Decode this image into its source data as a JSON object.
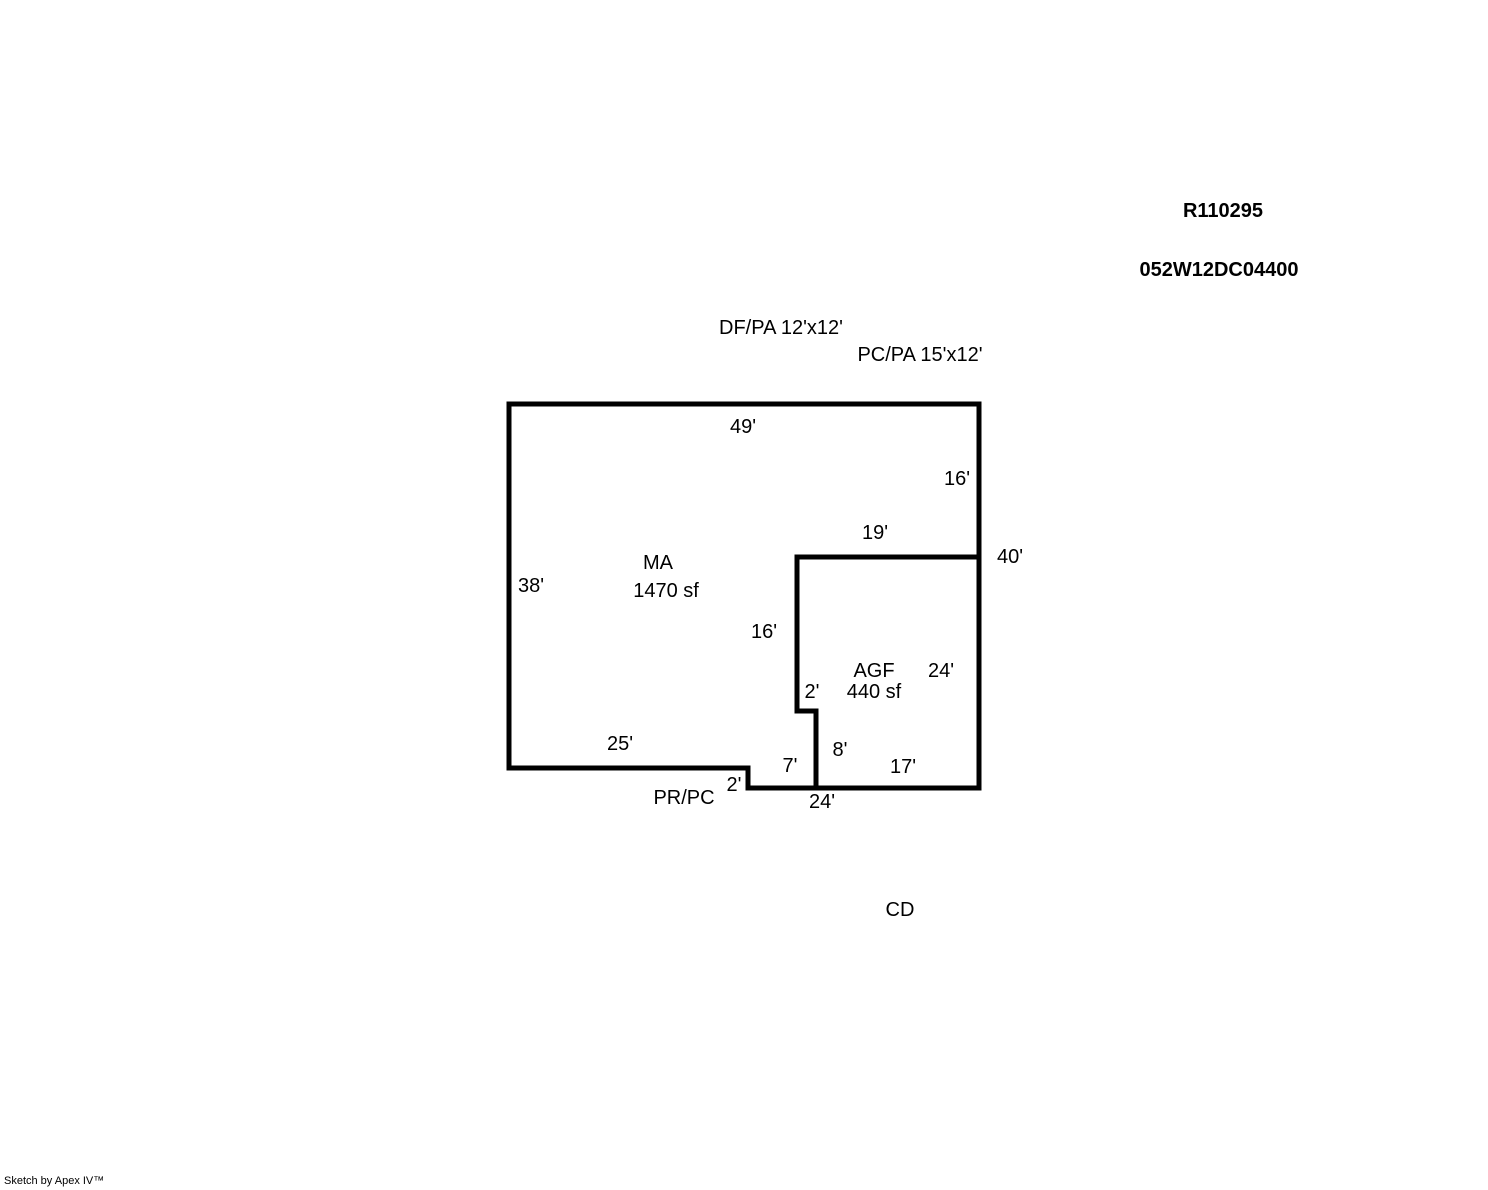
{
  "page": {
    "width": 1488,
    "height": 1190,
    "background_color": "#ffffff",
    "line_color": "#000000",
    "text_color": "#000000"
  },
  "header": {
    "record_number": "R110295",
    "parcel_number": "052W12DC04400"
  },
  "footer": {
    "credit": "Sketch by Apex IV™"
  },
  "sketch": {
    "areas": [
      {
        "code": "MA",
        "size_label": "1470 sf"
      },
      {
        "code": "AGF",
        "size_label": "440 sf"
      }
    ],
    "walls": [
      {
        "name": "main-outline",
        "closed": true,
        "points": [
          [
            509,
            404
          ],
          [
            979,
            404
          ],
          [
            979,
            788
          ],
          [
            748,
            788
          ],
          [
            748,
            768
          ],
          [
            509,
            768
          ]
        ]
      },
      {
        "name": "agf-partition",
        "closed": false,
        "points": [
          [
            979,
            557
          ],
          [
            797,
            557
          ],
          [
            797,
            711
          ],
          [
            816,
            711
          ],
          [
            816,
            788
          ]
        ]
      }
    ],
    "wall_stroke_px": 5,
    "labels": [
      {
        "name": "df-pa-annotation",
        "text": "DF/PA 12'x12'",
        "x": 781,
        "y": 328,
        "bold": false
      },
      {
        "name": "pc-pa-annotation",
        "text": "PC/PA 15'x12'",
        "x": 920,
        "y": 355,
        "bold": false
      },
      {
        "name": "dim-ma-top-49",
        "text": "49'",
        "x": 743,
        "y": 427,
        "bold": false
      },
      {
        "name": "dim-right-upper-16",
        "text": "16'",
        "x": 957,
        "y": 479,
        "bold": false
      },
      {
        "name": "dim-agf-top-19",
        "text": "19'",
        "x": 875,
        "y": 533,
        "bold": false
      },
      {
        "name": "dim-right-total-40",
        "text": "40'",
        "x": 1010,
        "y": 557,
        "bold": false
      },
      {
        "name": "ma-code",
        "text": "MA",
        "x": 658,
        "y": 563,
        "bold": false
      },
      {
        "name": "ma-size",
        "text": "1470 sf",
        "x": 666,
        "y": 591,
        "bold": false
      },
      {
        "name": "dim-ma-left-38",
        "text": "38'",
        "x": 531,
        "y": 586,
        "bold": false
      },
      {
        "name": "dim-agf-left-16",
        "text": "16'",
        "x": 764,
        "y": 632,
        "bold": false
      },
      {
        "name": "agf-code",
        "text": "AGF",
        "x": 874,
        "y": 671,
        "bold": false
      },
      {
        "name": "dim-agf-right-24",
        "text": "24'",
        "x": 941,
        "y": 671,
        "bold": false
      },
      {
        "name": "agf-size",
        "text": "440 sf",
        "x": 874,
        "y": 692,
        "bold": false
      },
      {
        "name": "dim-agf-step-2",
        "text": "2'",
        "x": 812,
        "y": 692,
        "bold": false
      },
      {
        "name": "dim-ma-bottom-25",
        "text": "25'",
        "x": 620,
        "y": 744,
        "bold": false
      },
      {
        "name": "dim-wall-8",
        "text": "8'",
        "x": 840,
        "y": 750,
        "bold": false
      },
      {
        "name": "dim-bottom-7",
        "text": "7'",
        "x": 790,
        "y": 766,
        "bold": false
      },
      {
        "name": "dim-agf-bottom-17",
        "text": "17'",
        "x": 903,
        "y": 767,
        "bold": false
      },
      {
        "name": "dim-step-down-2",
        "text": "2'",
        "x": 734,
        "y": 785,
        "bold": false
      },
      {
        "name": "pr-pc-annotation",
        "text": "PR/PC",
        "x": 684,
        "y": 798,
        "bold": false
      },
      {
        "name": "dim-bottom-total-24",
        "text": "24'",
        "x": 822,
        "y": 802,
        "bold": false
      },
      {
        "name": "cd-annotation",
        "text": "CD",
        "x": 900,
        "y": 910,
        "bold": false
      }
    ]
  }
}
